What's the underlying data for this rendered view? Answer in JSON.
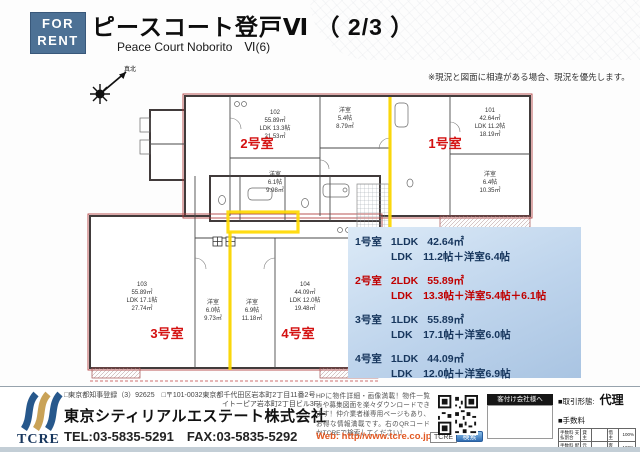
{
  "header": {
    "badge_line1": "FOR",
    "badge_line2": "RENT",
    "title": "ピースコート登戸Ⅵ （ 2/3 ）",
    "subtitle": "Peace Court Noborito　Ⅵ(6)",
    "notice": "※現況と図面に相違がある場合、現況を優先します。"
  },
  "compass": {
    "label": "真北"
  },
  "plan": {
    "units": {
      "u1": "1号室",
      "u2": "2号室",
      "u3": "3号室",
      "u4": "4号室"
    },
    "u2": [
      "102",
      "55.89㎡",
      "LDK 13.3帖",
      "21.53㎡"
    ],
    "u2b1": [
      "洋室",
      "6.1帖",
      "9.98㎡"
    ],
    "u2b2": [
      "洋室",
      "5.4帖",
      "8.79㎡"
    ],
    "u1": [
      "101",
      "42.64㎡",
      "LDK 11.2帖",
      "18.19㎡"
    ],
    "u1b": [
      "洋室",
      "6.4帖",
      "10.35㎡"
    ],
    "u3": [
      "103",
      "55.89㎡",
      "LDK 17.1帖",
      "27.74㎡"
    ],
    "u3b": [
      "洋室",
      "6.0帖",
      "9.73㎡"
    ],
    "u4": [
      "104",
      "44.09㎡",
      "LDK 12.0帖",
      "19.48㎡"
    ],
    "u4b": [
      "洋室",
      "6.9帖",
      "11.18㎡"
    ]
  },
  "info": {
    "rows": [
      {
        "room": "1号室",
        "type": "1LDK",
        "area": "42.64㎡",
        "detail": "LDK　11.2帖＋洋室6.4帖",
        "highlight": false
      },
      {
        "room": "2号室",
        "type": "2LDK",
        "area": "55.89㎡",
        "detail": "LDK　13.3帖＋洋室5.4帖＋6.1帖",
        "highlight": true
      },
      {
        "room": "3号室",
        "type": "1LDK",
        "area": "55.89㎡",
        "detail": "LDK　17.1帖＋洋室6.0帖",
        "highlight": false
      },
      {
        "room": "4号室",
        "type": "1LDK",
        "area": "44.09㎡",
        "detail": "LDK　12.0帖＋洋室6.9帖",
        "highlight": false
      }
    ]
  },
  "footer": {
    "logo_text": "TCRE",
    "registration": "□東京都知事登録（3）92625　□〒101-0032東京都千代田区岩本町2丁目11番2号",
    "registration2": "イトーピア岩本町2丁目ビル3F",
    "company": "東京シティリアルエステート株式会社",
    "tel_fax": "TEL:03-5835-5291　FAX:03-5835-5292",
    "promo": "HPに物件詳細・画像満載！物件一覧表や募集図面を楽々ダウンロードできます！仲介業者様専用ページもあり、お得な情報満載です。右のQRコードかTCREで検索してください！",
    "web": "Web: http//www.tcre.co.jp",
    "tcre_box": "TCRE",
    "search_btn": "検索",
    "agent_box": "客付け会社様へ",
    "deal_label": "■取引形態:",
    "deal_value": "代理",
    "fee_label": "■手数料",
    "fee_table": {
      "rows": [
        {
          "label": "手数料 支払割合",
          "l": "貸主",
          "r": "借主",
          "pct": "100%"
        },
        {
          "label": "手数料 配分割合",
          "l": "元付",
          "r": "客付",
          "pct": "100%"
        }
      ]
    }
  },
  "colors": {
    "badge_blue": "#4d7195",
    "accent_red": "#c00000",
    "info_navy": "#17365d",
    "highlight_yellow": "#ffd900",
    "web_orange": "#e25822",
    "logo_blue": "#27588c",
    "logo_gold": "#c9a257"
  }
}
